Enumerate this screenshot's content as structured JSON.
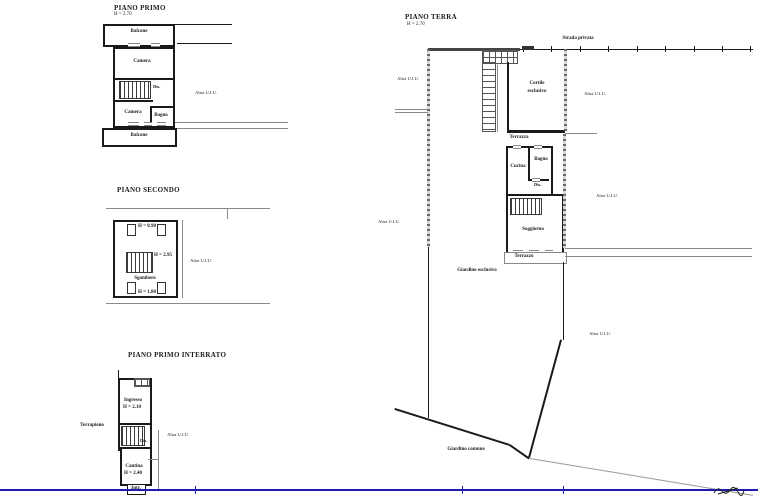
{
  "colors": {
    "wall": "#1a1a1a",
    "frame_blue": "#1c1cb0",
    "boundary_gray": "#6a6a6a"
  },
  "piano_primo": {
    "title": "PIANO PRIMO",
    "height": "H = 2.70",
    "balcone_top": "Balcone",
    "camera_top": "Camera",
    "dis": "Dis.",
    "camera_bottom": "Camera",
    "bagno": "Bagno",
    "balcone_bottom": "Balcone",
    "altra_uiu": "Altra U.I.U."
  },
  "piano_secondo": {
    "title": "PIANO SECONDO",
    "h_top": "H = 0.90",
    "h_mid": "H = 2.95",
    "sgombero": "Sgombero",
    "h_bottom": "H = 1.80",
    "altra_uiu": "Altra U.I.U."
  },
  "piano_interrato": {
    "title": "PIANO PRIMO INTERRATO",
    "ingresso": "Ingresso",
    "h_ingresso": "H = 2.10",
    "terrapieno": "Terrapieno",
    "dis": "Dis.",
    "altra_uiu": "Altra U.I.U.",
    "cantina": "Cantina",
    "h_cantina": "H = 2.40",
    "inter": "Intr."
  },
  "piano_terra": {
    "title": "PIANO TERRA",
    "height": "H = 2.70",
    "strada_privata": "Strada privata",
    "cortile_line1": "Cortile",
    "cortile_line2": "esclusivo",
    "terrazza": "Terrazza",
    "cucina": "Cucina",
    "bagno": "Bagno",
    "dis": "Dis.",
    "soggiorno": "Soggiorno",
    "terrazzo": "Terrazzo",
    "giardino_esclusivo": "Giardino esclusivo",
    "giardino_comune": "Giardino comune",
    "altra_uiu_left_top": "Altra U.I.U.",
    "altra_uiu_left_mid": "Altra U.I.U.",
    "altra_uiu_right_top": "Altra U.I.U.",
    "altra_uiu_right_mid": "Altra U.I.U.",
    "altra_uiu_right_bottom": "Altra U.I.U."
  }
}
